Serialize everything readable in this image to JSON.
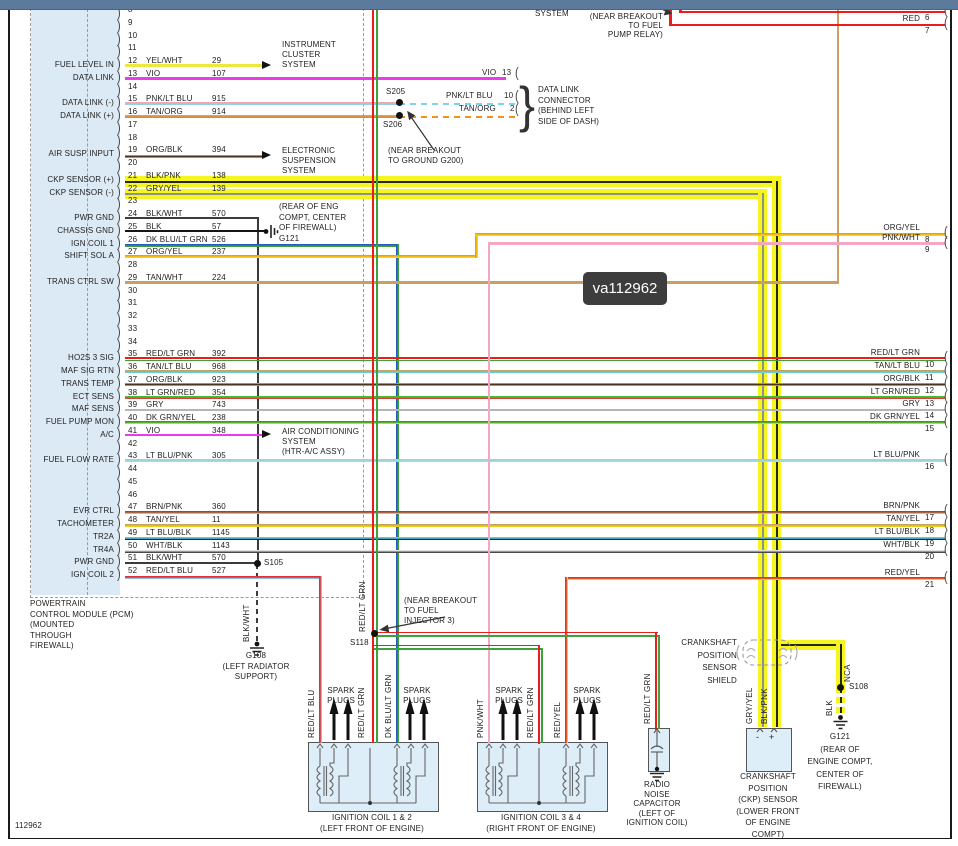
{
  "window": {
    "watermark": "va112962",
    "doc_number": "112962"
  },
  "pcm": {
    "title_lines": [
      "POWERTRAIN",
      "CONTROL MODULE (PCM)",
      "(MOUNTED",
      "THROUGH",
      "FIREWALL)"
    ],
    "pins": [
      {
        "num": "8"
      },
      {
        "num": "9"
      },
      {
        "num": "10"
      },
      {
        "num": "11"
      },
      {
        "num": "12",
        "name": "YEL/WHT",
        "gauge": "29",
        "label": "FUEL LEVEL IN"
      },
      {
        "num": "13",
        "name": "VIO",
        "gauge": "107",
        "label": "DATA LINK"
      },
      {
        "num": "14"
      },
      {
        "num": "15",
        "name": "PNK/LT BLU",
        "gauge": "915",
        "label": "DATA LINK (-)"
      },
      {
        "num": "16",
        "name": "TAN/ORG",
        "gauge": "914",
        "label": "DATA LINK (+)"
      },
      {
        "num": "17"
      },
      {
        "num": "18"
      },
      {
        "num": "19",
        "name": "ORG/BLK",
        "gauge": "394",
        "label": "AIR SUSP INPUT"
      },
      {
        "num": "20"
      },
      {
        "num": "21",
        "name": "BLK/PNK",
        "gauge": "138",
        "label": "CKP SENSOR (+)"
      },
      {
        "num": "22",
        "name": "GRY/YEL",
        "gauge": "139",
        "label": "CKP SENSOR (-)"
      },
      {
        "num": "23"
      },
      {
        "num": "24",
        "name": "BLK/WHT",
        "gauge": "570",
        "label": "PWR GND"
      },
      {
        "num": "25",
        "name": "BLK",
        "gauge": "57",
        "label": "CHASSIS GND"
      },
      {
        "num": "26",
        "name": "DK BLU/LT GRN",
        "gauge": "526",
        "label": "IGN COIL 1"
      },
      {
        "num": "27",
        "name": "ORG/YEL",
        "gauge": "237",
        "label": "SHIFT SOL A"
      },
      {
        "num": "28"
      },
      {
        "num": "29",
        "name": "TAN/WHT",
        "gauge": "224",
        "label": "TRANS CTRL SW"
      },
      {
        "num": "30"
      },
      {
        "num": "31"
      },
      {
        "num": "32"
      },
      {
        "num": "33"
      },
      {
        "num": "34"
      },
      {
        "num": "35",
        "name": "RED/LT GRN",
        "gauge": "392",
        "label": "HO2S 3 SIG"
      },
      {
        "num": "36",
        "name": "TAN/LT BLU",
        "gauge": "968",
        "label": "MAF SIG RTN"
      },
      {
        "num": "37",
        "name": "ORG/BLK",
        "gauge": "923",
        "label": "TRANS TEMP"
      },
      {
        "num": "38",
        "name": "LT GRN/RED",
        "gauge": "354",
        "label": "ECT SENS"
      },
      {
        "num": "39",
        "name": "GRY",
        "gauge": "743",
        "label": "MAF SENS"
      },
      {
        "num": "40",
        "name": "DK GRN/YEL",
        "gauge": "238",
        "label": "FUEL PUMP MON"
      },
      {
        "num": "41",
        "name": "VIO",
        "gauge": "348",
        "label": "A/C"
      },
      {
        "num": "42"
      },
      {
        "num": "43",
        "name": "LT BLU/PNK",
        "gauge": "305",
        "label": "FUEL FLOW RATE"
      },
      {
        "num": "44"
      },
      {
        "num": "45"
      },
      {
        "num": "46"
      },
      {
        "num": "47",
        "name": "BRN/PNK",
        "gauge": "360",
        "label": "EVR CTRL"
      },
      {
        "num": "48",
        "name": "TAN/YEL",
        "gauge": "11",
        "label": "TACHOMETER"
      },
      {
        "num": "49",
        "name": "LT BLU/BLK",
        "gauge": "1145",
        "label": "TR2A"
      },
      {
        "num": "50",
        "name": "WHT/BLK",
        "gauge": "1143",
        "label": "TR4A"
      },
      {
        "num": "51",
        "name": "BLK/WHT",
        "gauge": "570",
        "label": "PWR GND"
      },
      {
        "num": "52",
        "name": "RED/LT BLU",
        "gauge": "527",
        "label": "IGN COIL 2"
      }
    ]
  },
  "right_connector": {
    "pins": [
      {
        "num": "6",
        "name": "RED"
      },
      {
        "num": "7",
        "name": "RED"
      },
      {
        "num": "8",
        "name": "ORG/YEL"
      },
      {
        "num": "9",
        "name": "PNK/WHT"
      },
      {
        "num": "10",
        "name": "RED/LT GRN"
      },
      {
        "num": "11",
        "name": "TAN/LT BLU"
      },
      {
        "num": "12",
        "name": "ORG/BLK"
      },
      {
        "num": "13",
        "name": "LT GRN/RED"
      },
      {
        "num": "14",
        "name": "GRY"
      },
      {
        "num": "15",
        "name": "DK GRN/YEL"
      },
      {
        "num": "16",
        "name": "LT BLU/PNK"
      },
      {
        "num": "17",
        "name": "BRN/PNK"
      },
      {
        "num": "18",
        "name": "TAN/YEL"
      },
      {
        "num": "19",
        "name": "LT BLU/BLK"
      },
      {
        "num": "20",
        "name": "WHT/BLK"
      },
      {
        "num": "21",
        "name": "RED/YEL"
      }
    ]
  },
  "blocks": {
    "system_top": [
      "SYSTEM"
    ],
    "s123_note": [
      "(NEAR BREAKOUT",
      "TO FUEL",
      "PUMP RELAY)"
    ],
    "instrument_cluster": [
      "INSTRUMENT",
      "CLUSTER",
      "SYSTEM"
    ],
    "electronic_suspension": [
      "ELECTRONIC",
      "SUSPENSION",
      "SYSTEM"
    ],
    "air_conditioning": [
      "AIR CONDITIONING",
      "SYSTEM",
      "(HTR-A/C ASSY)"
    ],
    "data_link_connector": [
      "DATA LINK",
      "CONNECTOR",
      "(BEHIND LEFT",
      "SIDE OF DASH)"
    ],
    "g200_note": [
      "(NEAR BREAKOUT",
      "TO GROUND G200)"
    ],
    "inj3_note": [
      "(NEAR BREAKOUT",
      "TO FUEL",
      "INJECTOR 3)"
    ],
    "g121_left": [
      "(REAR OF ENG",
      "COMPT, CENTER",
      "OF FIREWALL)",
      "G121"
    ],
    "g108": [
      "G108",
      "(LEFT RADIATOR",
      "SUPPORT)"
    ],
    "g121_right": [
      "G121",
      "(REAR OF",
      "ENGINE COMPT,",
      "CENTER OF",
      "FIREWALL)"
    ],
    "coil12_label": [
      "IGNITION COIL 1 & 2",
      "(LEFT FRONT OF ENGINE)"
    ],
    "coil34_label": [
      "IGNITION COIL 3 & 4",
      "(RIGHT FRONT OF ENGINE)"
    ],
    "spark_plugs": [
      "SPARK",
      "PLUGS"
    ],
    "cap_label": [
      "RADIO",
      "NOISE",
      "CAPACITOR",
      "(LEFT OF",
      "IGNITION COIL)"
    ],
    "ckp_label": [
      "CRANKSHAFT",
      "POSITION",
      "(CKP) SENSOR",
      "(LOWER FRONT",
      "OF ENGINE",
      "COMPT)"
    ],
    "shield_label": [
      "CRANKSHAFT",
      "POSITION",
      "SENSOR",
      "SHIELD"
    ]
  },
  "splices": {
    "s123": "S123",
    "s205": "S205",
    "s206": "S206",
    "s118": "S118",
    "s105": "S105",
    "s108": "S108"
  },
  "dlc_stubs": {
    "vio": {
      "name": "VIO",
      "pin": "13"
    },
    "pnk": {
      "name": "PNK/LT BLU",
      "pin": "10"
    },
    "tan": {
      "name": "TAN/ORG",
      "pin": "2"
    }
  },
  "vertical_labels": {
    "g108_wire": "BLK/WHT",
    "inj_wire": "RED/LT GRN",
    "coil12_w1": "RED/LT BLU",
    "coil12_w2": "RED/LT GRN",
    "coil12_w3": "DK BLU/LT GRN",
    "coil34_w1": "PNK/WHT",
    "coil34_w2": "RED/LT GRN",
    "coil34_w3": "RED/YEL",
    "cap_wire": "RED/LT GRN",
    "ckp_w1": "GRY/YEL",
    "ckp_w2": "BLK/PNK",
    "drain_nca": "NCA",
    "drain_blk": "BLK"
  },
  "terminals": {
    "minus": "-",
    "plus": "+"
  },
  "colors": {
    "shield_yellow": "#f5f520",
    "red": "#ea1c1c",
    "green": "#3da23d",
    "violet": "#e93de9",
    "pcm_fill": "#dceaf6"
  }
}
